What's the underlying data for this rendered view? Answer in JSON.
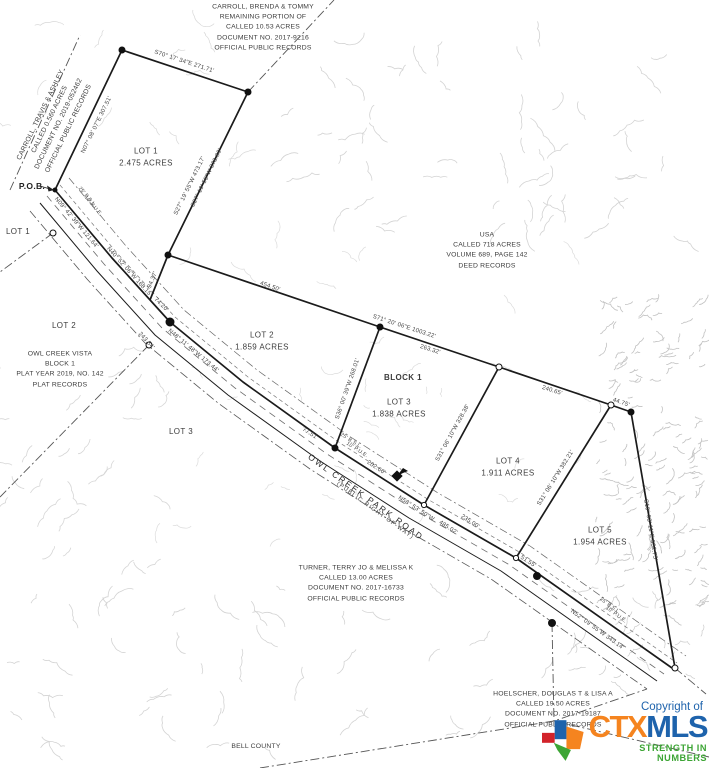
{
  "map": {
    "labels": [
      {
        "name": "owner-carroll-brenda",
        "cls": "owner",
        "x": 263,
        "y": 28,
        "rot": 0,
        "text": "CARROLL, BRENDA & TOMMY\nREMAINING PORTION OF\nCALLED 10.53 ACRES\nDOCUMENT NO. 2017-9216\nOFFICIAL PUBLIC RECORDS"
      },
      {
        "name": "owner-carroll-travis",
        "cls": "owner",
        "x": 55,
        "y": 122,
        "rot": -64,
        "text": "CARROLL, TRAVIS & ASHLEY\nCALLED 0.560 ACRES\nDOCUMENT NO. 2019-052462\nOFFICIAL PUBLIC RECORDS"
      },
      {
        "name": "owner-usa",
        "cls": "owner",
        "x": 487,
        "y": 251,
        "rot": 0,
        "text": "USA\nCALLED 718 ACRES\nVOLUME 689, PAGE 142\nDEED RECORDS"
      },
      {
        "name": "owner-owl-creek-vista",
        "cls": "owner",
        "x": 60,
        "y": 370,
        "rot": 0,
        "text": "OWL CREEK VISTA\nBLOCK 1\nPLAT YEAR 2019, NO. 142\nPLAT RECORDS"
      },
      {
        "name": "owner-turner",
        "cls": "owner",
        "x": 356,
        "y": 584,
        "rot": 0,
        "text": "TURNER, TERRY JO & MELISSA K\nCALLED 13.00 ACRES\nDOCUMENT NO. 2017-16733\nOFFICIAL PUBLIC RECORDS"
      },
      {
        "name": "owner-hoelscher",
        "cls": "owner",
        "x": 553,
        "y": 710,
        "rot": 0,
        "text": "HOELSCHER, DOUGLAS T & LISA A\nCALLED 19.50 ACRES\nDOCUMENT NO. 2017-19187\nOFFICIAL PUBLIC RECORDS"
      },
      {
        "name": "county-label",
        "cls": "owner",
        "x": 256,
        "y": 747,
        "rot": 0,
        "text": "BELL COUNTY"
      },
      {
        "name": "lot1-label",
        "cls": "lot",
        "x": 146,
        "y": 158,
        "rot": 0,
        "text": "LOT 1\n2.475 ACRES"
      },
      {
        "name": "lot2-label",
        "cls": "lot",
        "x": 262,
        "y": 342,
        "rot": 0,
        "text": "LOT 2\n1.859 ACRES"
      },
      {
        "name": "lot3-label",
        "cls": "lot",
        "x": 399,
        "y": 409,
        "rot": 0,
        "text": "LOT 3\n1.838 ACRES"
      },
      {
        "name": "lot4-label",
        "cls": "lot",
        "x": 508,
        "y": 468,
        "rot": 0,
        "text": "LOT 4\n1.911 ACRES"
      },
      {
        "name": "lot5-label",
        "cls": "lot",
        "x": 600,
        "y": 537,
        "rot": 0,
        "text": "LOT 5\n1.954 ACRES"
      },
      {
        "name": "block1-label",
        "cls": "lot bold",
        "x": 403,
        "y": 378,
        "rot": 0,
        "text": "BLOCK 1"
      },
      {
        "name": "adjacent-lot1-label",
        "cls": "lot",
        "x": 18,
        "y": 232,
        "rot": 0,
        "text": "LOT 1"
      },
      {
        "name": "adjacent-lot2-label",
        "cls": "lot",
        "x": 64,
        "y": 326,
        "rot": 0,
        "text": "LOT 2"
      },
      {
        "name": "adjacent-lot3-label",
        "cls": "lot",
        "x": 181,
        "y": 432,
        "rot": 0,
        "text": "LOT 3"
      },
      {
        "name": "pob-label",
        "cls": "pob",
        "x": 32,
        "y": 186,
        "rot": 0,
        "text": "P.O.B."
      },
      {
        "name": "bearing-lot1-north",
        "cls": "bearing",
        "x": 184,
        "y": 62,
        "rot": 18,
        "text": "S70° 17' 34\"E   271.71'"
      },
      {
        "name": "bearing-lot1-west",
        "cls": "bearing",
        "x": 97,
        "y": 125,
        "rot": -64,
        "text": "N07° 08' 07\"E   307.51'"
      },
      {
        "name": "bearing-lot1-east-a",
        "cls": "bearing",
        "x": 190,
        "y": 186,
        "rot": -64,
        "text": "S27° 19' 55\"W   473.17'"
      },
      {
        "name": "bearing-lot1-east-b",
        "cls": "bearing",
        "x": 207,
        "y": 178,
        "rot": -64,
        "text": "S27° 19' 55\"W   378.80'"
      },
      {
        "name": "dim-94",
        "cls": "bearing",
        "x": 153,
        "y": 280,
        "rot": -68,
        "text": "94.37'"
      },
      {
        "name": "bearing-road-1",
        "cls": "bearing",
        "x": 76,
        "y": 223,
        "rot": 50,
        "text": "N09° 42' 39\"W   121.64'"
      },
      {
        "name": "bsl-label-1",
        "cls": "bearing tiny",
        "x": 87,
        "y": 197,
        "rot": 50,
        "text": "25' B.S.L."
      },
      {
        "name": "pue-label-1",
        "cls": "bearing tiny",
        "x": 93,
        "y": 206,
        "rot": 50,
        "text": "10' P.U.E."
      },
      {
        "name": "bearing-road-2",
        "cls": "bearing",
        "x": 129,
        "y": 272,
        "rot": 48,
        "text": "N40° 52' 06\"W   168.15'"
      },
      {
        "name": "dim-243",
        "cls": "bearing",
        "x": 146,
        "y": 341,
        "rot": 48,
        "text": "243.54'"
      },
      {
        "name": "dim-74",
        "cls": "bearing",
        "x": 161,
        "y": 305,
        "rot": 45,
        "text": "74.20'"
      },
      {
        "name": "bearing-road-3",
        "cls": "bearing",
        "x": 193,
        "y": 351,
        "rot": 40,
        "text": "N48° 11' 48\"W   173.44'"
      },
      {
        "name": "dim-77",
        "cls": "bearing",
        "x": 310,
        "y": 434,
        "rot": 33,
        "text": "77.51'"
      },
      {
        "name": "bsl-label-2",
        "cls": "bearing tiny",
        "x": 351,
        "y": 441,
        "rot": 33,
        "text": "25' B.S.L."
      },
      {
        "name": "pue-label-2",
        "cls": "bearing tiny",
        "x": 357,
        "y": 450,
        "rot": 33,
        "text": "10' P.U.E."
      },
      {
        "name": "dim-202",
        "cls": "bearing",
        "x": 376,
        "y": 468,
        "rot": 33,
        "text": "202.66'"
      },
      {
        "name": "road-name-label",
        "cls": "roadname",
        "x": 366,
        "y": 497,
        "rot": 36,
        "text": "OWL CREEK PARK ROAD"
      },
      {
        "name": "road-row-label",
        "cls": "rowlbl",
        "x": 375,
        "y": 511,
        "rot": 36,
        "text": "(PUBLIC RIGHT-OF-WAY)"
      },
      {
        "name": "bearing-road-4",
        "cls": "bearing",
        "x": 416,
        "y": 509,
        "rot": 33,
        "text": "N58° 53' 50\"W"
      },
      {
        "name": "dim-485",
        "cls": "bearing",
        "x": 448,
        "y": 528,
        "rot": 33,
        "text": "485.02'"
      },
      {
        "name": "dim-235",
        "cls": "bearing",
        "x": 470,
        "y": 522,
        "rot": 33,
        "text": "235.00'"
      },
      {
        "name": "dim-51",
        "cls": "bearing",
        "x": 528,
        "y": 562,
        "rot": 32,
        "text": "51.55'"
      },
      {
        "name": "bsl-label-3",
        "cls": "bearing tiny",
        "x": 610,
        "y": 606,
        "rot": 36,
        "text": "25' B.S.L."
      },
      {
        "name": "pue-label-3",
        "cls": "bearing tiny",
        "x": 616,
        "y": 615,
        "rot": 36,
        "text": "10' P.U.E."
      },
      {
        "name": "bearing-road-5",
        "cls": "bearing",
        "x": 597,
        "y": 630,
        "rot": 36,
        "text": "N52° 09' 55\"W   343.14'"
      },
      {
        "name": "bearing-north-line",
        "cls": "bearing",
        "x": 404,
        "y": 327,
        "rot": 18,
        "text": "S71° 20' 06\"E   1003.22'"
      },
      {
        "name": "dim-454",
        "cls": "bearing",
        "x": 270,
        "y": 287,
        "rot": 19,
        "text": "454.50'"
      },
      {
        "name": "dim-263",
        "cls": "bearing",
        "x": 430,
        "y": 350,
        "rot": 18,
        "text": "263.32'"
      },
      {
        "name": "dim-240",
        "cls": "bearing",
        "x": 552,
        "y": 391,
        "rot": 18,
        "text": "240.65'"
      },
      {
        "name": "dim-44",
        "cls": "bearing",
        "x": 621,
        "y": 403,
        "rot": 19,
        "text": "44.75'"
      },
      {
        "name": "bearing-lot2-lot3",
        "cls": "bearing",
        "x": 348,
        "y": 389,
        "rot": -71,
        "text": "S36° 00' 39\"W   268.01'"
      },
      {
        "name": "bearing-lot3-lot4",
        "cls": "bearing",
        "x": 453,
        "y": 433,
        "rot": -61,
        "text": "S31° 06' 10\"W   328.38'"
      },
      {
        "name": "bearing-lot4-lot5",
        "cls": "bearing",
        "x": 556,
        "y": 478,
        "rot": -58,
        "text": "S31° 06' 10\"W   382.21'"
      },
      {
        "name": "bearing-lot5-east",
        "cls": "bearing",
        "x": 650,
        "y": 530,
        "rot": 81,
        "text": "S10° 03' 11\"E   532.75'"
      }
    ]
  },
  "logo": {
    "copyright": "Copyright of",
    "ctx": "CTX",
    "mls": "MLS",
    "tagline": "STRENGTH IN NUMBERS",
    "colors": {
      "orange": "#F5841F",
      "blue": "#1E63AC",
      "green": "#3DA535",
      "red": "#D2232A"
    }
  },
  "colors": {
    "boundary": "#1b1b1b",
    "contour": "#d0d0d0",
    "text": "#3c3c3c"
  }
}
